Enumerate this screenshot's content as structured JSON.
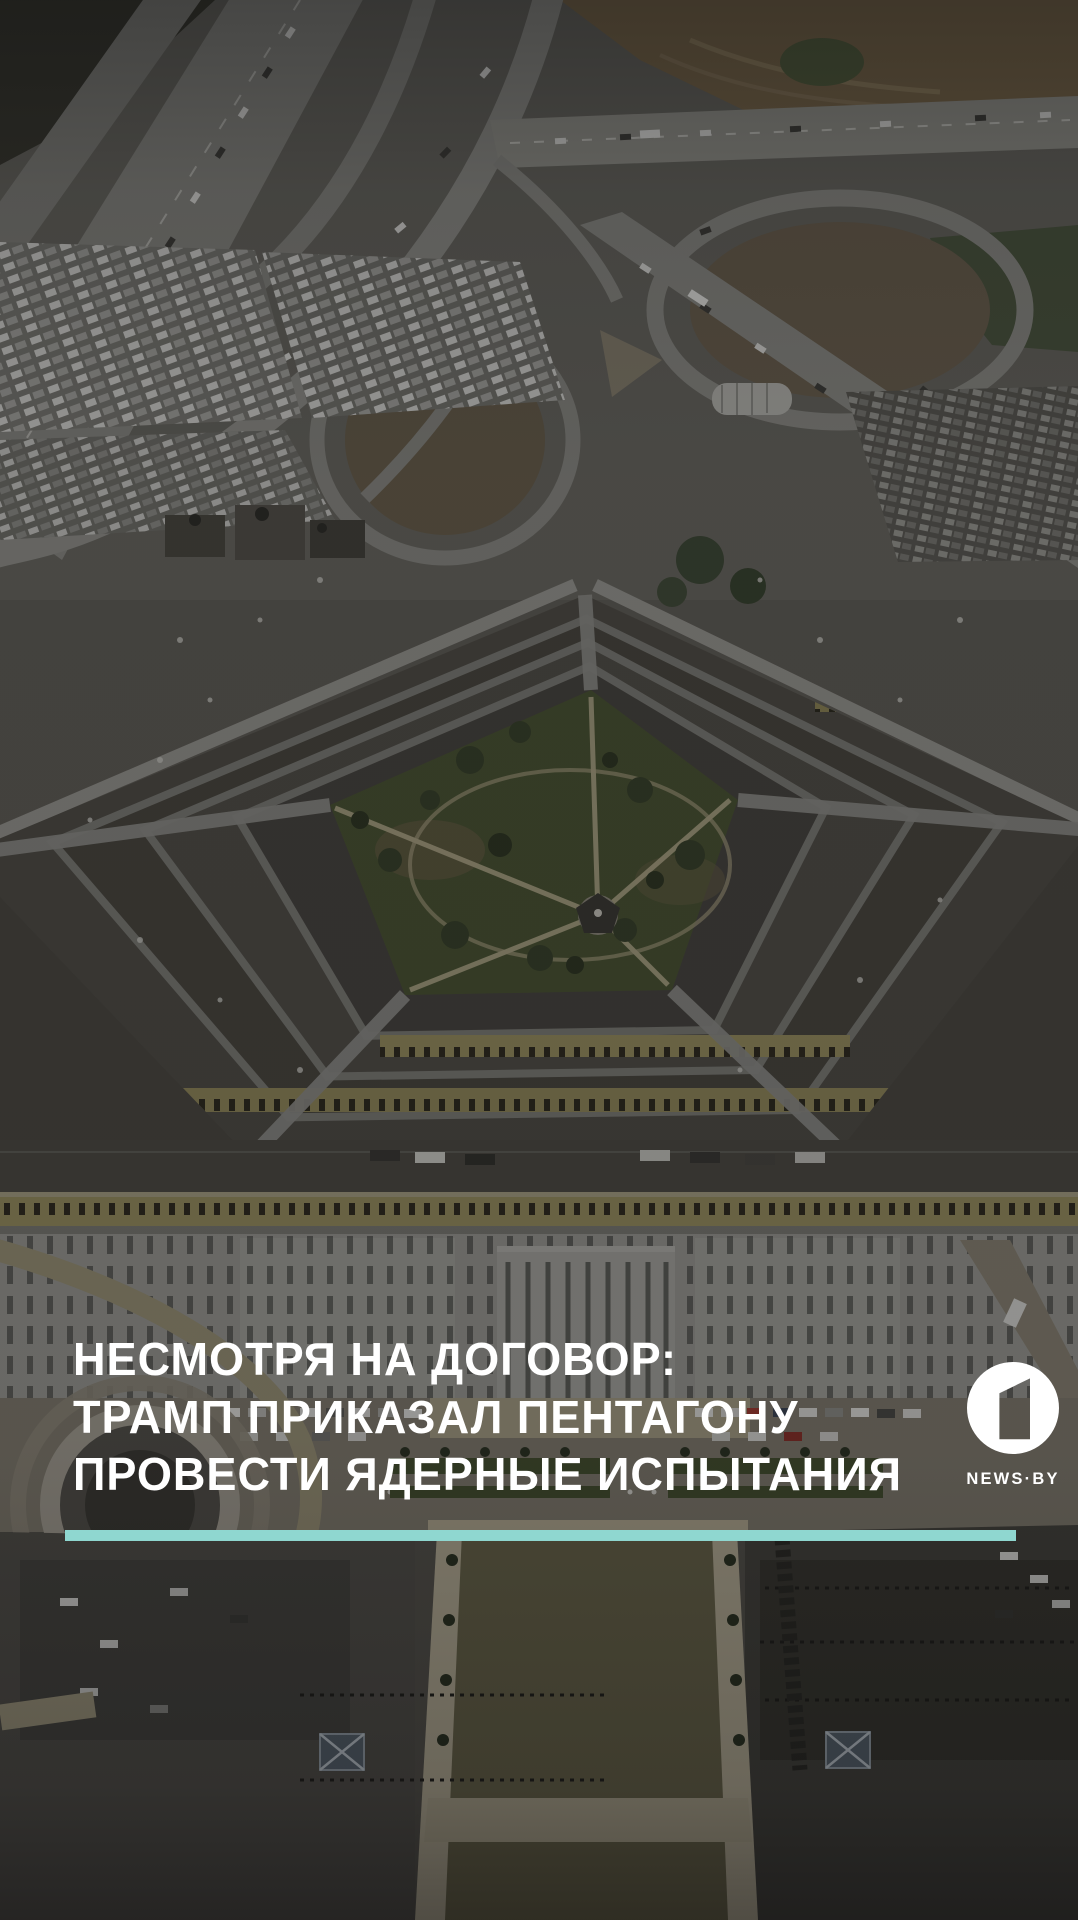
{
  "headline": {
    "line1": "НЕСМОТРЯ НА ДОГОВОР:",
    "line2": "ТРАМП ПРИКАЗАЛ ПЕНТАГОНУ",
    "line3": "ПРОВЕСТИ ЯДЕРНЫЕ ИСПЫТАНИЯ",
    "color": "#ffffff"
  },
  "branding": {
    "logo_symbol": "1",
    "logo_label": "channel-one-logo",
    "logo_color": "#ffffff",
    "wordmark": "NEWS·BY",
    "wordmark_color": "#ffffff"
  },
  "divider": {
    "color": "#8fd7d0"
  },
  "photo": {
    "alt": "Аэрофотоснимок здания Пентагона с автомагистралями и парковками"
  }
}
